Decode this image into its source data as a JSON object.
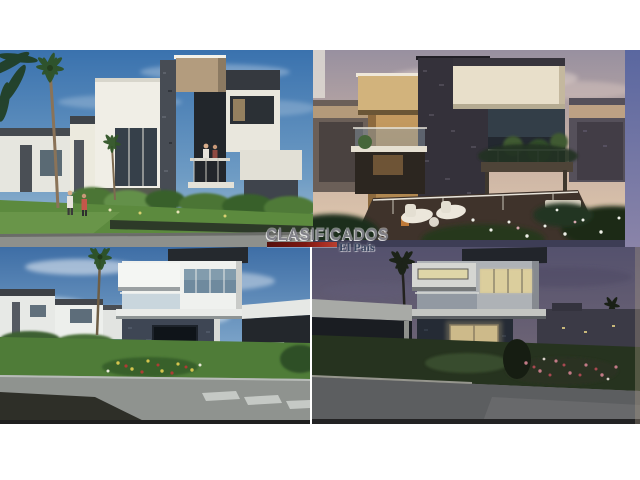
{
  "page": {
    "background_color": "#ffffff",
    "frame_top_height_px": 50,
    "frame_bottom_height_px": 56
  },
  "watermark": {
    "brand": "CLASIFICADOS",
    "publication": "El País",
    "brand_color": "#83838b",
    "bar_gradient": [
      "#55100c",
      "#b84030"
    ],
    "publication_color": "#39455f"
  },
  "collage": {
    "grid": "2x2",
    "quadrants": [
      {
        "id": "top-left",
        "scene": "day-render-white-modern-houses-palms-lawn-people"
      },
      {
        "id": "top-right",
        "scene": "sunset-render-beige-house-stone-tower-terrace-lounge"
      },
      {
        "id": "bottom-left",
        "scene": "day-render-house-carport-silver-car-red-car-garden"
      },
      {
        "id": "bottom-right",
        "scene": "night-render-house-lit-windows-white-car-palm"
      }
    ],
    "colors": {
      "day_sky": "#3a72ae",
      "sunset_sky": "#9890a0",
      "night_sky": "#54516d",
      "lawn_green": "#4f7c38",
      "stone_dark": "#3e4654",
      "beige_wall": "#cda367",
      "white_wall": "#eff1ee",
      "road_gray": "#8f938f"
    }
  }
}
